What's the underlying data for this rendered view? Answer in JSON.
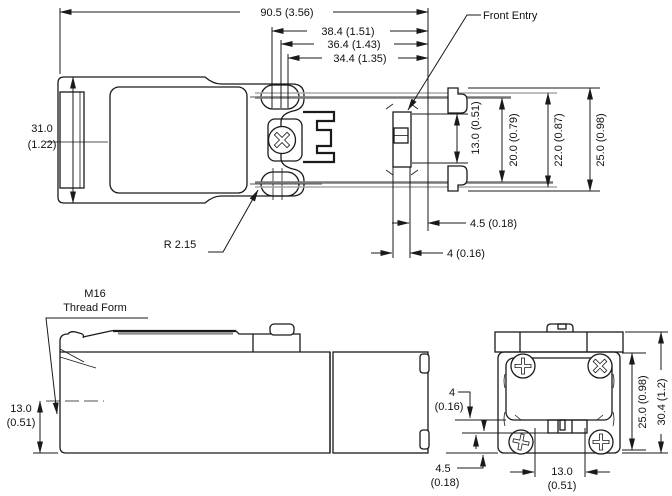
{
  "drawing": {
    "title": "limit-switch-dimension-drawing",
    "colors": {
      "line": "#1a1a1a",
      "rail_light": "#a8a8a8",
      "rail_dark": "#787878",
      "background": "#ffffff"
    },
    "top_view": {
      "dim_overall": "90.5 (3.56)",
      "dim_hole_outer": "38.4 (1.51)",
      "dim_hole_mid": "36.4 (1.43)",
      "dim_hole_inner": "34.4 (1.35)",
      "front_entry_label": "Front Entry",
      "dim_height_mm": "31.0",
      "dim_height_in": "(1.22)",
      "radius_label": "R 2.15",
      "dim_slot_13": "13.0 (0.51)",
      "dim_slot_20": "20.0 (0.79)",
      "dim_slot_22": "22.0 (0.87)",
      "dim_slot_25": "25.0 (0.98)",
      "dim_gap_45": "4.5 (0.18)",
      "dim_gap_4": "4 (0.16)"
    },
    "side_view": {
      "thread_label_1": "M16",
      "thread_label_2": "Thread Form",
      "dim_entry_height_mm": "13.0",
      "dim_entry_height_in": "(0.51)"
    },
    "end_view": {
      "dim_top_gap_mm": "4",
      "dim_top_gap_in": "(0.16)",
      "dim_bottom_gap_mm": "4.5",
      "dim_bottom_gap_in": "(0.18)",
      "dim_width_mm": "13.0",
      "dim_width_in": "(0.51)",
      "dim_body_height": "25.0 (0.98)",
      "dim_total_height": "30.4 (1.2)"
    }
  }
}
